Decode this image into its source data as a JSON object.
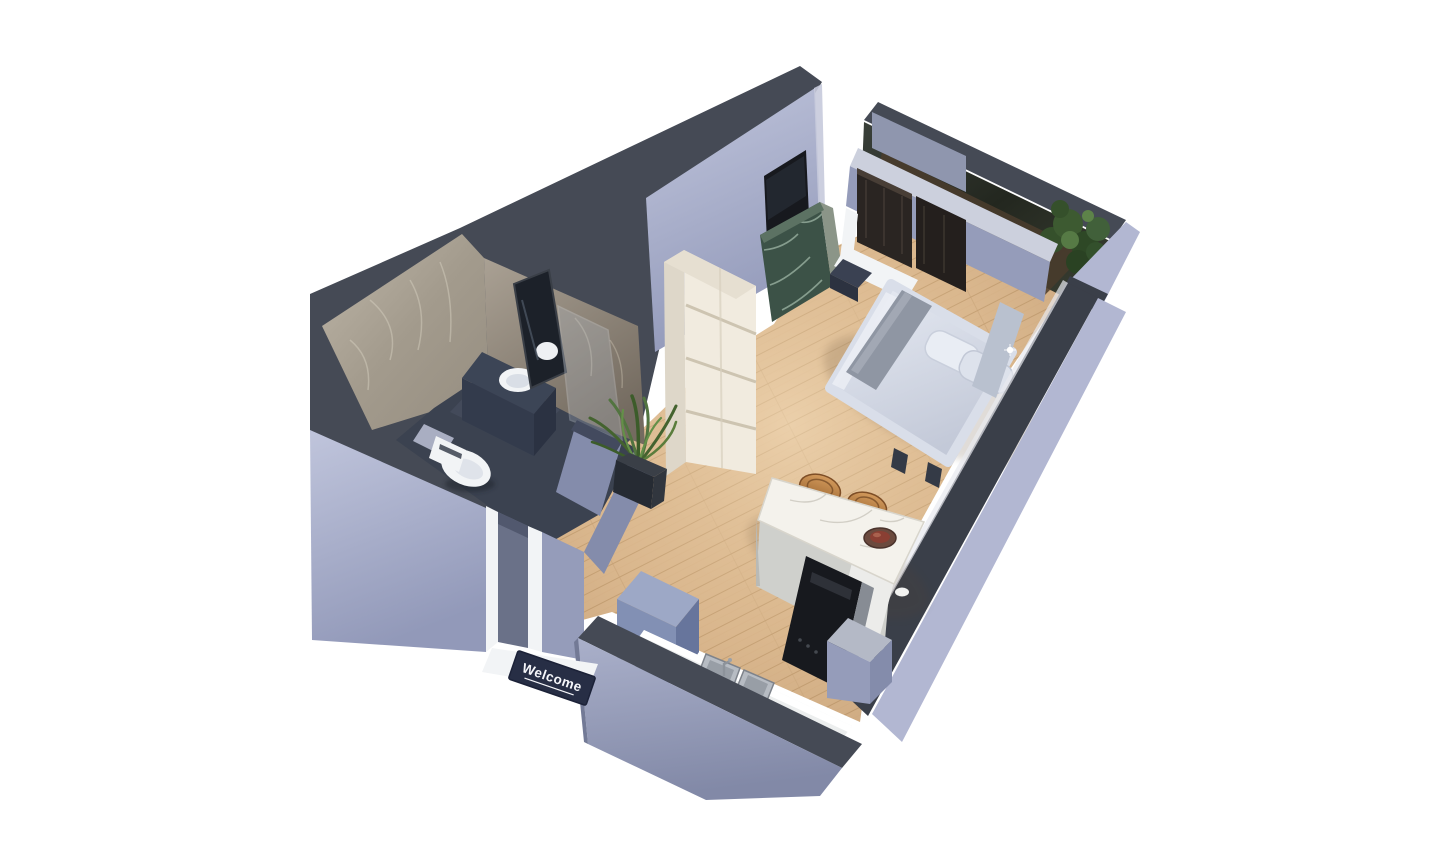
{
  "scene": {
    "type": "isometric-3d-floor-plan-render",
    "background": "#ffffff",
    "doormat": {
      "text": "Welcome"
    },
    "palette": {
      "background": "#ffffff",
      "wall_top": "#454a55",
      "wall_top_dark": "#3a3f49",
      "wall_light": "#b2b7d2",
      "wall_mid": "#959cba",
      "wall_deep": "#848cab",
      "wood": "#d7b38a",
      "wood_line": "#bb9165",
      "bath_floor": "#3b4250",
      "marble_light": "#b5ad9f",
      "marble_dark": "#8c8478",
      "green_marble": "#3c5247",
      "shelf_cream": "#f1ebdf",
      "shelf_side": "#ded7c9",
      "bed_duvet": "#d9dee9",
      "bed_stripe": "#8f96a3",
      "island_top": "#f4f2ec",
      "island_side": "#cfd0cc",
      "stool_copper": "#bd8347",
      "plant_green": "#4a6a36",
      "plant_dark": "#2c4424",
      "balcony_glass": "#30352e",
      "balcony_floor": "#4a3c2d",
      "wardrobe_dark": "#2a2522",
      "appliance_black": "#17191e",
      "steel": "#b7bcc3",
      "white_fixture": "#f2f4f6",
      "mat_bg": "#272e45",
      "mat_fg": "#f5f6fa"
    },
    "rooms": [
      "bathroom",
      "entry-hall",
      "living-bedroom",
      "kitchen",
      "balcony"
    ],
    "furniture": [
      "toilet",
      "vanity-sink",
      "mirror",
      "shower-glass",
      "shelf-unit",
      "potted-plant",
      "tv-panel",
      "green-marble-console",
      "wardrobe",
      "bed",
      "pillows",
      "nightstand",
      "kitchen-island",
      "bar-stools",
      "serving-bowl",
      "refrigerator",
      "kitchen-counter",
      "double-sink",
      "oven-column",
      "balcony-plant",
      "welcome-mat"
    ]
  }
}
